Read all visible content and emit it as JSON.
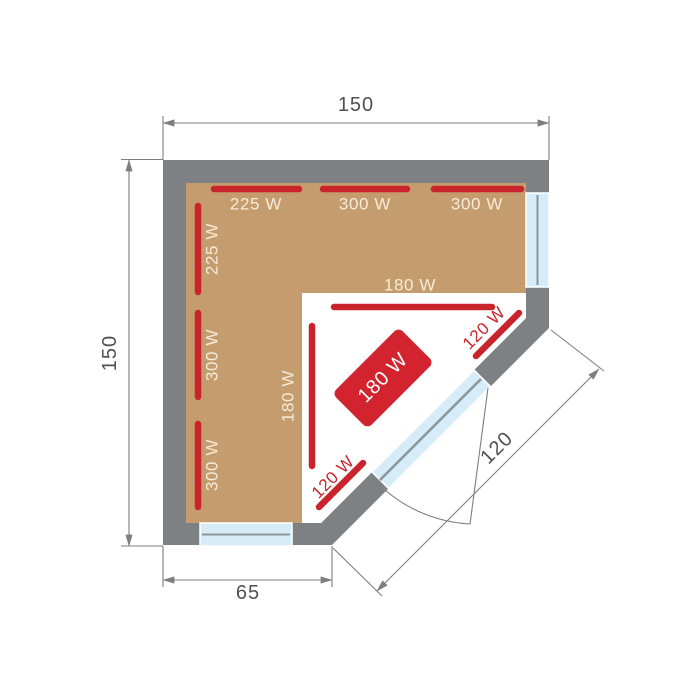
{
  "colors": {
    "wall": "#7e8184",
    "bench": "#c59c6e",
    "floor": "#ffffff",
    "heater": "#c9242b",
    "stove": "#d2232e",
    "label_cream": "#f6ecd9",
    "glass": "#d6ecf9",
    "pane": "#8d9399",
    "pane_soft": "#a9bcc6",
    "dim_line": "#7d7e80",
    "dim_text": "#4f5052",
    "bg": "#ffffff"
  },
  "dimensions": {
    "top": "150",
    "left": "150",
    "bottom": "65",
    "diagonal": "120"
  },
  "heaters": {
    "top_wall": [
      "225 W",
      "300 W",
      "300 W"
    ],
    "left_wall": [
      "225 W",
      "300 W",
      "300 W"
    ],
    "inner_horizontal": "180 W",
    "inner_vertical": "180 W",
    "diagonal_upper": "120 W",
    "diagonal_lower": "120 W",
    "stove": "180 W"
  }
}
